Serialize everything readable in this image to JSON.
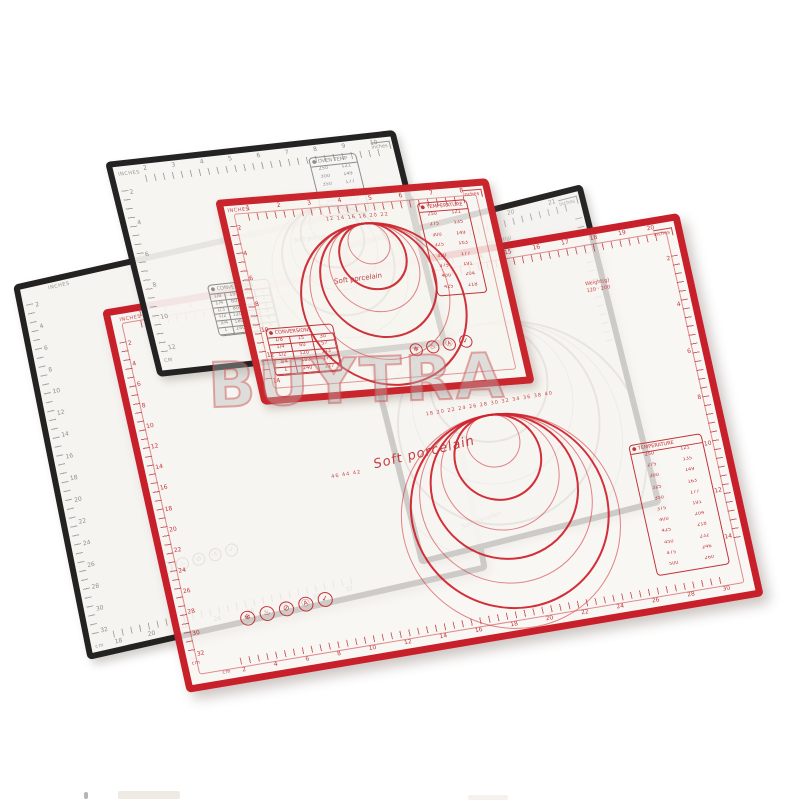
{
  "watermark": {
    "text": "BUYTRA"
  },
  "mats": {
    "back_black": {
      "name": "black pastry mat (back, top-left)",
      "brand": "Soft porcelain",
      "unit_top": "INCHES",
      "unit_left": "CM",
      "corner_unit": "inches",
      "rulers": {
        "top": [
          "2",
          "3",
          "4",
          "5",
          "6",
          "7",
          "8",
          "9",
          "10"
        ],
        "left": [
          "2",
          "4",
          "6",
          "8",
          "10",
          "12"
        ]
      },
      "rings": {
        "cx": 197,
        "ty": 60,
        "radii": [
          18,
          30,
          42,
          54,
          66
        ]
      },
      "tables": {
        "oven": {
          "title": "● OVEN TEMP",
          "rows": [
            [
              "250",
              "121"
            ],
            [
              "300",
              "149"
            ],
            [
              "350",
              "177"
            ],
            [
              "400",
              "204"
            ],
            [
              "450",
              "232"
            ],
            [
              "500",
              "260"
            ]
          ]
        },
        "grid": {
          "title": "● CONVERSIONS",
          "rows": [
            [
              "1/8",
              "15",
              "30",
              "1"
            ],
            [
              "1/4",
              "60",
              "57",
              "2"
            ],
            [
              "1/3",
              "80",
              "85",
              "3"
            ],
            [
              "1/2",
              "120",
              "113",
              "4"
            ],
            [
              "3/4",
              "180",
              "170",
              "6"
            ],
            [
              "1",
              "240",
              "227",
              "8"
            ]
          ]
        }
      }
    },
    "small_red": {
      "name": "small red pastry mat",
      "brand": "Soft porcelain",
      "unit_top": "INCHES",
      "corner_unit": "inches",
      "rulers": {
        "top": [
          "1",
          "2",
          "3",
          "4",
          "5",
          "6",
          "7",
          "8"
        ],
        "left": [
          "2",
          "4",
          "6",
          "8",
          "10",
          "12",
          "14"
        ]
      },
      "rings": {
        "cx": 134,
        "ty": 27,
        "radii": [
          20,
          32,
          44,
          56,
          68,
          80
        ]
      },
      "diameters": "12 14 16 18 20 22",
      "tables": {
        "temperature": {
          "title": "● TEMPERATURE",
          "rows": [
            [
              "250",
              "121"
            ],
            [
              "275",
              "135"
            ],
            [
              "300",
              "149"
            ],
            [
              "325",
              "163"
            ],
            [
              "350",
              "177"
            ],
            [
              "375",
              "191"
            ],
            [
              "400",
              "204"
            ],
            [
              "425",
              "218"
            ]
          ]
        },
        "grid": {
          "title": "● CONVERSIONS",
          "rows": [
            [
              "1/8",
              "15",
              "30"
            ],
            [
              "1/4",
              "60",
              "57"
            ],
            [
              "1/2",
              "120",
              "113"
            ],
            [
              "3/4",
              "180",
              "170"
            ],
            [
              "1",
              "240",
              "227"
            ]
          ]
        }
      },
      "care_icons": [
        "❄",
        "♨",
        "Ⓐ",
        "✓"
      ]
    },
    "right_black": {
      "name": "black pastry mat (behind large red)",
      "brand": "Soft porcelain",
      "corner_unit": "inches",
      "rulers": {
        "top": [
          "20",
          "21"
        ]
      },
      "weight_lines": [
        "Weight(g)",
        "120 · 200",
        "150 · 230"
      ],
      "rings": {
        "cx": 103,
        "ty": 104,
        "radii": [
          35,
          58,
          80,
          100,
          120,
          138
        ]
      },
      "diameters": "26 28 30 32 34 36"
    },
    "left_black": {
      "name": "black pastry mat (left)",
      "unit_top": "INCHES",
      "unit_bottom": "cm",
      "rulers": {
        "left": [
          "2",
          "4",
          "6",
          "8",
          "10",
          "12",
          "14",
          "16",
          "18",
          "20",
          "22",
          "24",
          "26",
          "28",
          "30",
          "32"
        ],
        "bottom": [
          "18",
          "20",
          "22",
          "24",
          "26",
          "28",
          "30",
          "32"
        ]
      },
      "care_icons": [
        "❄",
        "♨",
        "⊘",
        "Ⓐ",
        "✓"
      ]
    },
    "large_red": {
      "name": "large red pastry mat (front)",
      "brand": "Soft porcelain",
      "unit_top": "INCHES",
      "corner_unit": "inches",
      "unit_left": "cm",
      "unit_bottom": "cm",
      "rulers": {
        "top": [
          "1",
          "2",
          "3",
          "4",
          "5",
          "6",
          "7",
          "8",
          "9",
          "10",
          "11",
          "12",
          "13",
          "14",
          "15",
          "16",
          "17",
          "18",
          "19",
          "20"
        ],
        "left": [
          "2",
          "4",
          "6",
          "8",
          "10",
          "12",
          "14",
          "16",
          "18",
          "20",
          "22",
          "24",
          "26",
          "28",
          "30",
          "32"
        ],
        "right": [
          "2",
          "4",
          "6",
          "8",
          "10",
          "12",
          "14"
        ],
        "bottom": [
          "2",
          "4",
          "6",
          "8",
          "10",
          "12",
          "14",
          "16",
          "18",
          "20",
          "22",
          "24",
          "26",
          "28",
          "30"
        ]
      },
      "rings": {
        "cx": 346,
        "ty": 160,
        "radii": [
          26,
          42,
          58,
          72,
          85,
          97,
          108
        ]
      },
      "diameters": "18 20 22 24 26 28 30 32 34 36 38 40",
      "diameters2": "46 44 42",
      "weight_lines": [
        "Weight(g)",
        "120 · 200"
      ],
      "tables": {
        "temperature": {
          "title": "● TEMPERATURE",
          "rows": [
            [
              "250",
              "121"
            ],
            [
              "275",
              "135"
            ],
            [
              "300",
              "149"
            ],
            [
              "325",
              "163"
            ],
            [
              "350",
              "177"
            ],
            [
              "375",
              "191"
            ],
            [
              "400",
              "204"
            ],
            [
              "425",
              "218"
            ],
            [
              "450",
              "232"
            ],
            [
              "475",
              "246"
            ],
            [
              "500",
              "260"
            ]
          ]
        }
      },
      "care_icons": [
        "❄",
        "♨",
        "⊘",
        "Ⓐ",
        "✓"
      ]
    }
  }
}
